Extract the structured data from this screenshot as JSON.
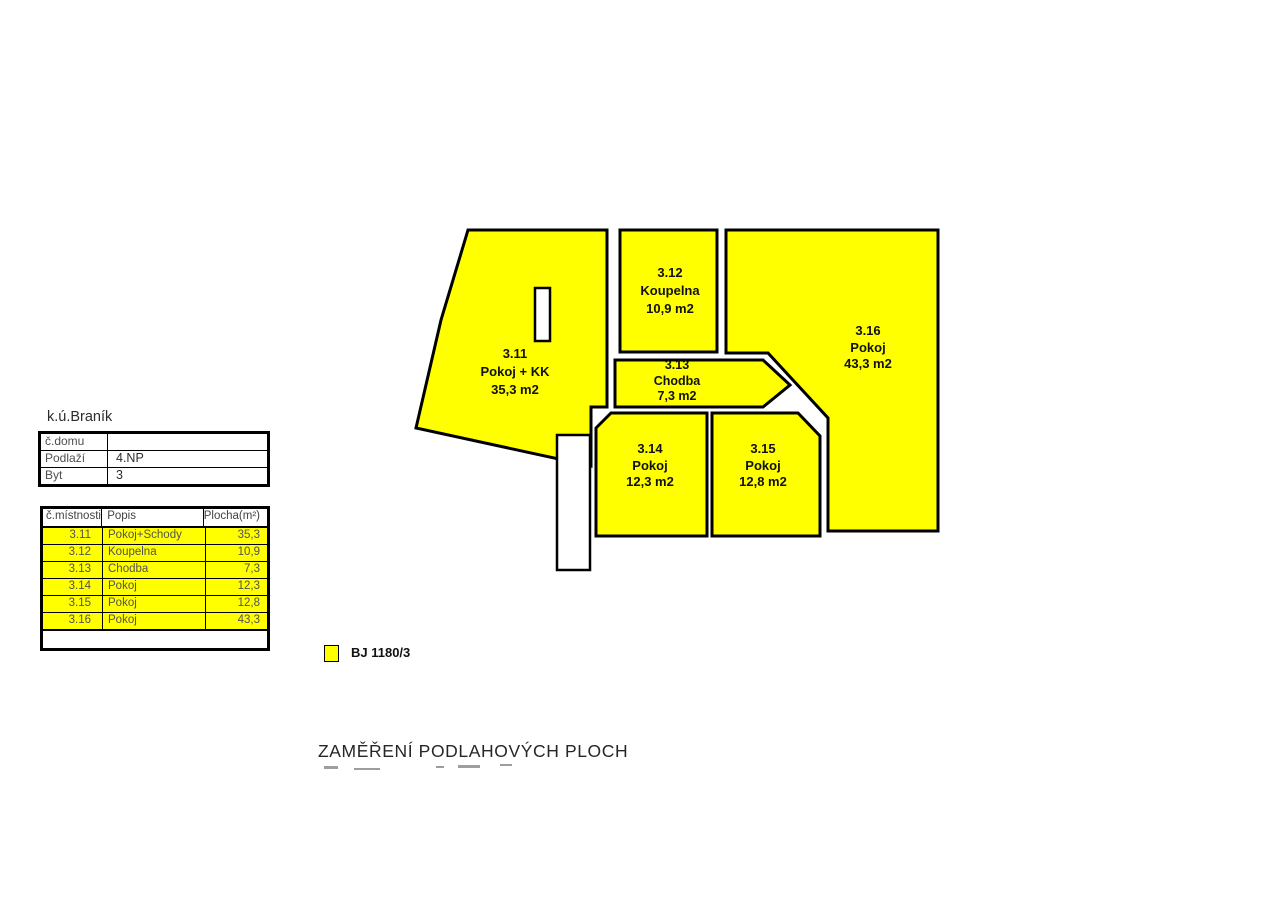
{
  "plan": {
    "fill_color": "#FFFF00",
    "wall_color": "#000000",
    "rooms": [
      {
        "id": "3.11",
        "name": "Pokoj + KK",
        "area": "35,3 m2"
      },
      {
        "id": "3.12",
        "name": "Koupelna",
        "area": "10,9 m2"
      },
      {
        "id": "3.13",
        "name": "Chodba",
        "area": "7,3 m2"
      },
      {
        "id": "3.14",
        "name": "Pokoj",
        "area": "12,3 m2"
      },
      {
        "id": "3.15",
        "name": "Pokoj",
        "area": "12,8 m2"
      },
      {
        "id": "3.16",
        "name": "Pokoj",
        "area": "43,3 m2"
      }
    ]
  },
  "location_label": "k.ú.Braník",
  "info_table": {
    "rows": [
      {
        "label": "č.domu",
        "value": ""
      },
      {
        "label": "Podlaží",
        "value": "4.NP"
      },
      {
        "label": "Byt",
        "value": "3"
      }
    ]
  },
  "area_table": {
    "headers": [
      "č.místnosti",
      "Popis",
      "Plocha(m²)"
    ],
    "rows": [
      {
        "no": "3.11",
        "popis": "Pokoj+Schody",
        "plocha": "35,3"
      },
      {
        "no": "3.12",
        "popis": "Koupelna",
        "plocha": "10,9"
      },
      {
        "no": "3.13",
        "popis": "Chodba",
        "plocha": "7,3"
      },
      {
        "no": "3.14",
        "popis": "Pokoj",
        "plocha": "12,3"
      },
      {
        "no": "3.15",
        "popis": "Pokoj",
        "plocha": "12,8"
      },
      {
        "no": "3.16",
        "popis": "Pokoj",
        "plocha": "43,3"
      }
    ]
  },
  "legend": {
    "swatch_color": "#FFFF00",
    "label": "BJ 1180/3"
  },
  "title": "ZAMĚŘENÍ PODLAHOVÝCH PLOCH"
}
